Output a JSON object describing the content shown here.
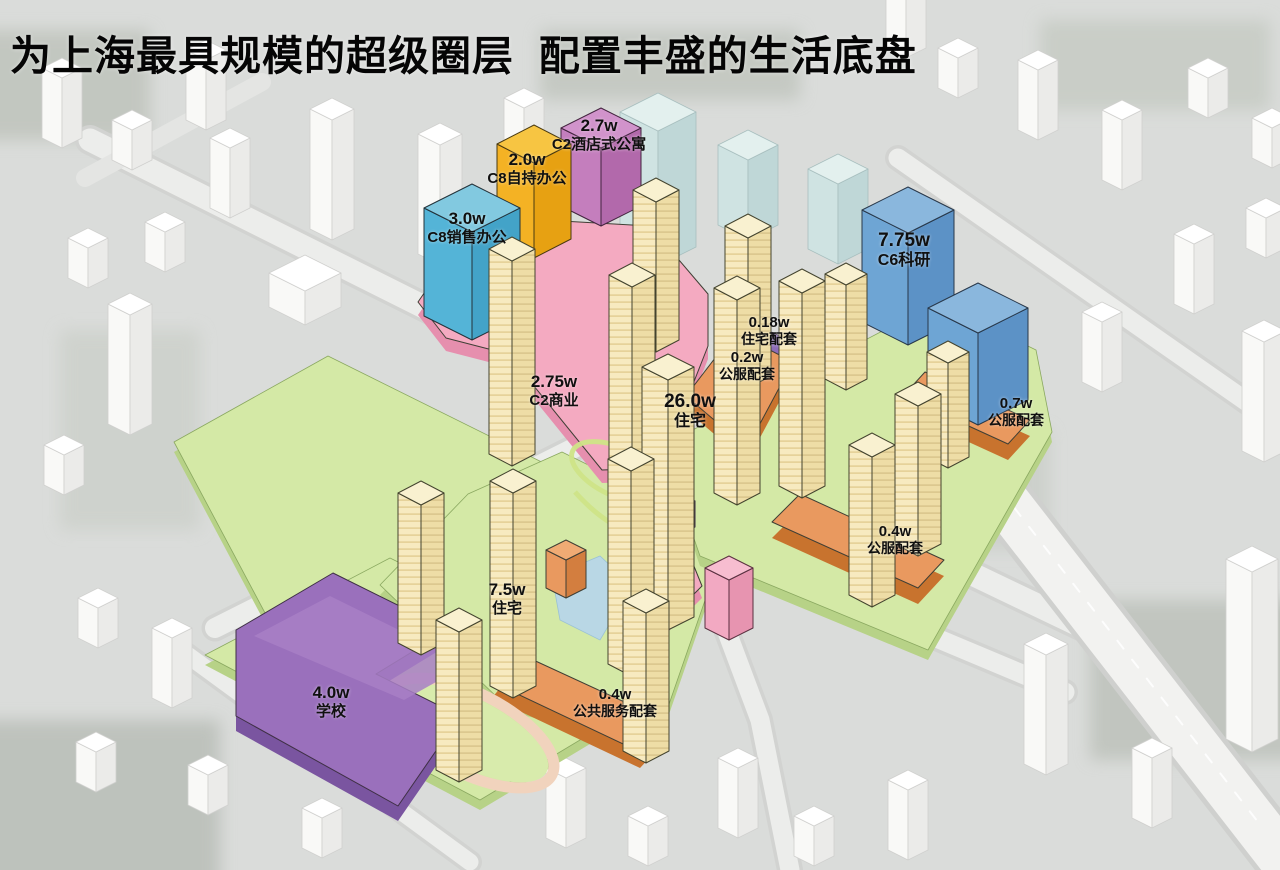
{
  "title": "为上海最具规模的超级圈层  配置丰盛的生活底盘",
  "unit_note": "w",
  "labels": [
    {
      "id": "c8-sales-office",
      "value": "3.0w",
      "name": "C8销售办公",
      "color": "#54b4d7"
    },
    {
      "id": "c8-self-office",
      "value": "2.0w",
      "name": "C8自持办公",
      "color": "#f4b224"
    },
    {
      "id": "c2-hotel-apartment",
      "value": "2.7w",
      "name": "C2酒店式公寓",
      "color": "#c47ebd"
    },
    {
      "id": "c6-research",
      "value": "7.75w",
      "name": "C6科研",
      "color": "#6ea5d4"
    },
    {
      "id": "c2-commercial",
      "value": "2.75w",
      "name": "C2商业",
      "color": "#f4aac1"
    },
    {
      "id": "residential-26w",
      "value": "26.0w",
      "name": "住宅",
      "color": "#f6e8bd"
    },
    {
      "id": "residential-support",
      "value": "0.18w",
      "name": "住宅配套",
      "color": "#8d6cb8"
    },
    {
      "id": "public-service-02w",
      "value": "0.2w",
      "name": "公服配套",
      "color": "#e9995f"
    },
    {
      "id": "public-service-07w",
      "value": "0.7w",
      "name": "公服配套",
      "color": "#e9995f"
    },
    {
      "id": "public-service-04w",
      "value": "0.4w",
      "name": "公服配套",
      "color": "#e9995f"
    },
    {
      "id": "residential-75w",
      "value": "7.5w",
      "name": "住宅",
      "color": "#f6e8bd"
    },
    {
      "id": "school",
      "value": "4.0w",
      "name": "学校",
      "color": "#9a70bc"
    },
    {
      "id": "public-service-amenity",
      "value": "0.4w",
      "name": "公共服务配套",
      "color": "#e9995f"
    }
  ],
  "palette": {
    "residential_tower": "#f6e8bd",
    "commercial_podium_pink": "#f4aac1",
    "sales_office_blue": "#54b4d7",
    "self_office_orange": "#f4b224",
    "hotel_apartment_magenta": "#c47ebd",
    "research_blue": "#6ea5d4",
    "public_service_orange": "#e9995f",
    "residential_support_purple": "#8d6cb8",
    "school_purple": "#9a70bc",
    "green_space": "#d4e9a6",
    "context_building": "#ffffff",
    "context_cyan": "#d8eae8",
    "road": "#ecedeb",
    "background": "#dadcda"
  }
}
